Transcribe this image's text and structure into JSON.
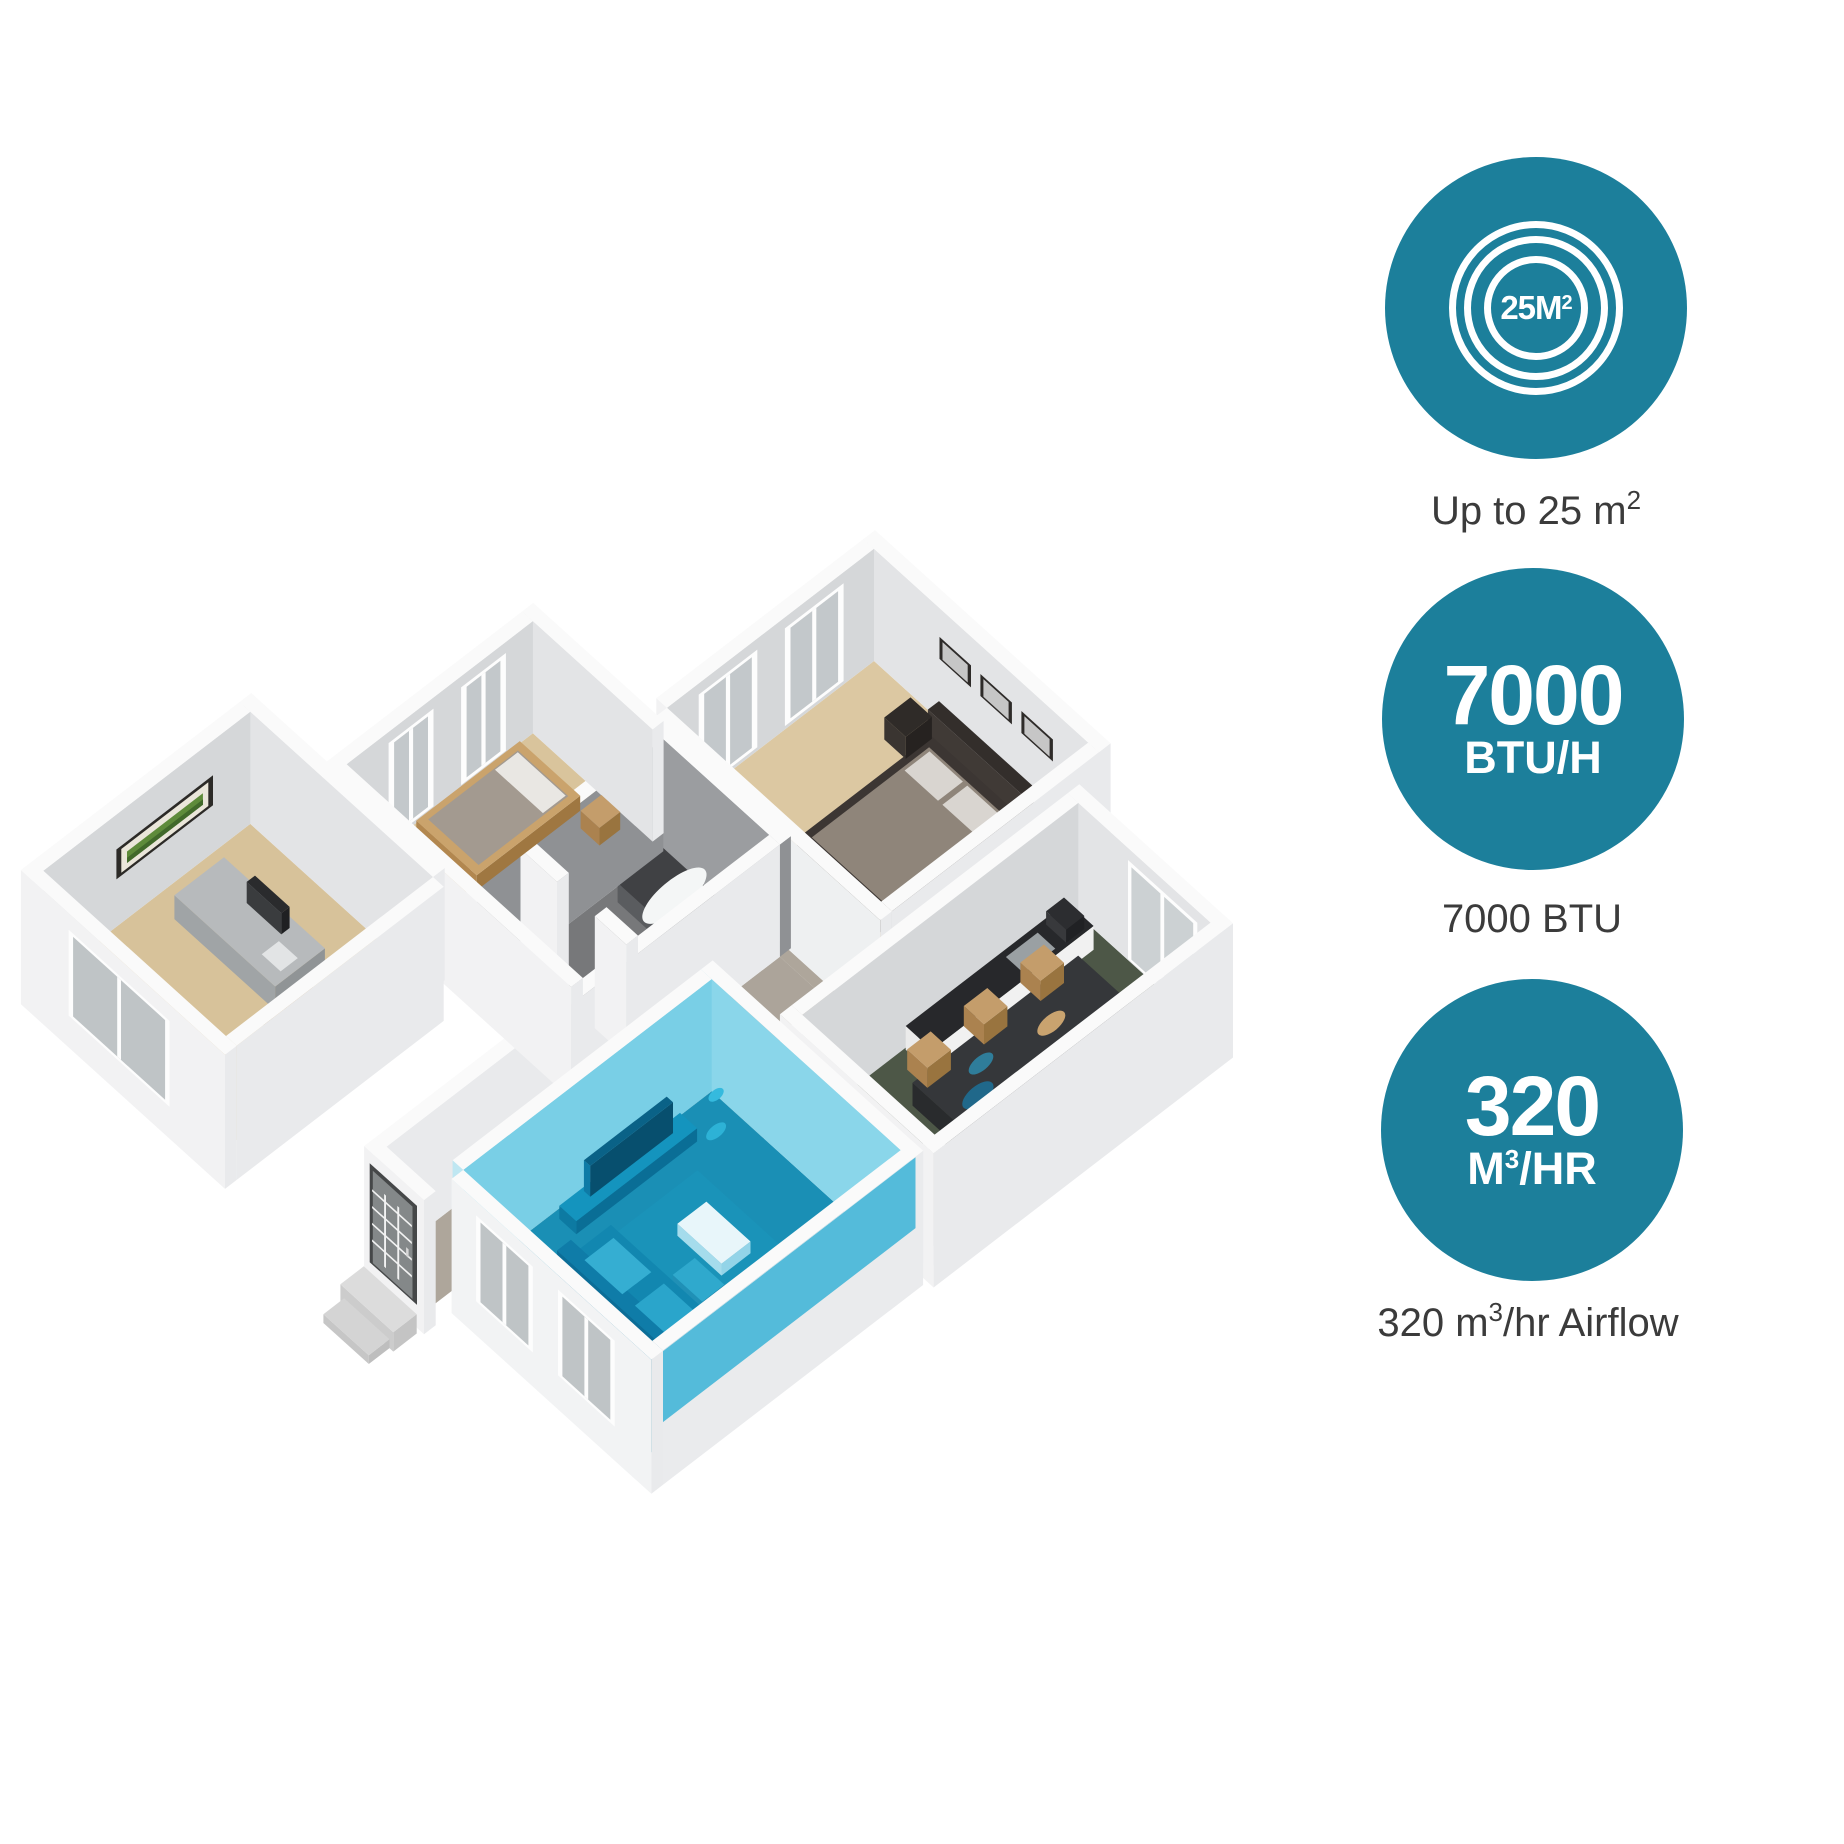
{
  "floorplan": {
    "highlighted_room_label": {
      "value": "25 m",
      "sup": "2"
    }
  },
  "stats": [
    {
      "name": "coverage",
      "badge_value": "25M",
      "badge_sup": "2",
      "caption": {
        "prefix": "Up to 25 m",
        "sup": "2",
        "suffix": ""
      }
    },
    {
      "name": "cooling",
      "badge_line1": "7000",
      "badge_line2": "BTU/H",
      "caption": {
        "prefix": "7000 BTU",
        "sup": "",
        "suffix": ""
      }
    },
    {
      "name": "airflow",
      "badge_line1": "320",
      "badge_line2": {
        "prefix": "M",
        "sup": "3",
        "suffix": "/HR"
      },
      "caption": {
        "prefix": "320 m",
        "sup": "3",
        "suffix": "/hr Airflow"
      }
    }
  ],
  "colors": {
    "accent_teal": "#1c7f9b",
    "caption_text": "#3b3b3b",
    "highlight_floor": "#1a8fb5",
    "highlight_wall": "#79cfe6"
  }
}
